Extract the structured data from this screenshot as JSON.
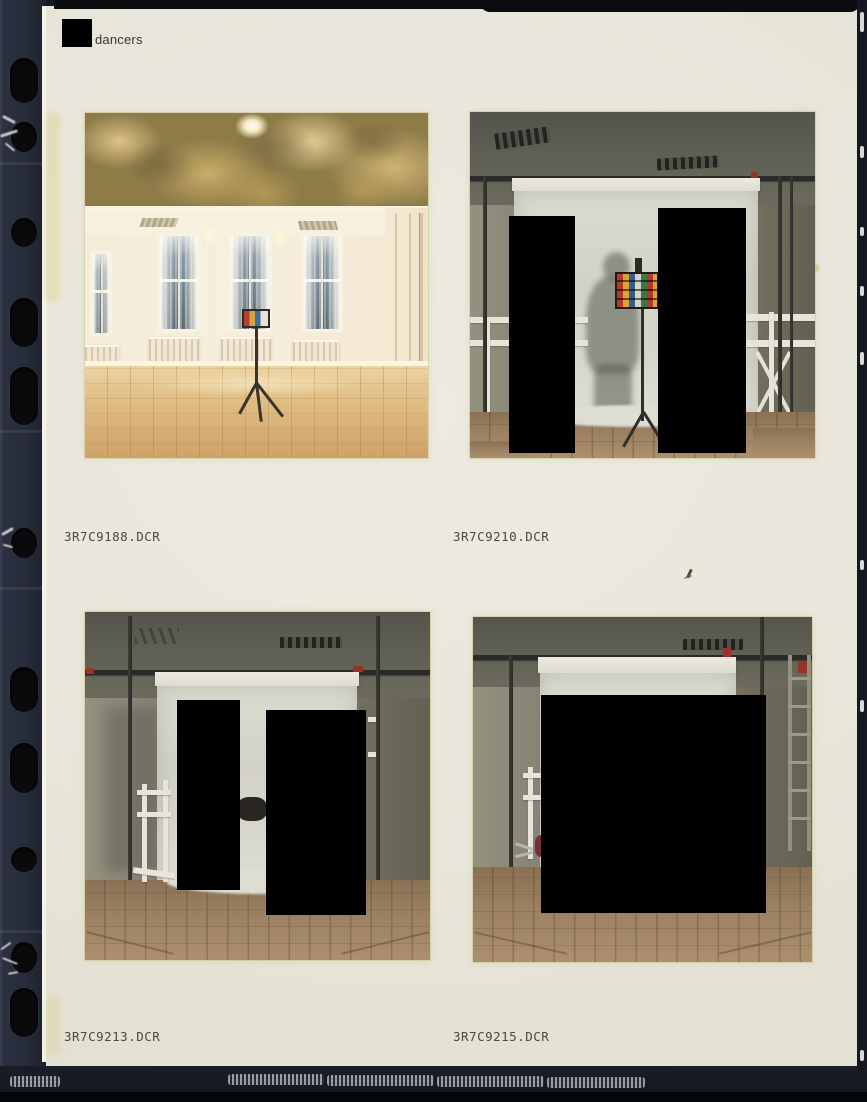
{
  "header": {
    "label": "dancers"
  },
  "photos": [
    {
      "filename": "3R7C9188.DCR",
      "content": "empty studio room with painted frieze, curtained windows and test chart on tripod",
      "redaction_boxes": 0
    },
    {
      "filename": "3R7C9210.DCR",
      "content": "white studio backdrop with figure shadow and color chart on stand",
      "redaction_boxes": 2
    },
    {
      "filename": "3R7C9213.DCR",
      "content": "white studio backdrop with equipment on wood floor",
      "redaction_boxes": 2
    },
    {
      "filename": "3R7C9215.DCR",
      "content": "white studio backdrop with ladder at right",
      "redaction_boxes": 1
    }
  ],
  "colors": {
    "page_background": "#e9e7db",
    "sleeve": "#272c3a",
    "redaction": "#000000",
    "filename_text": "#4a4942",
    "header_text": "#37362f"
  }
}
